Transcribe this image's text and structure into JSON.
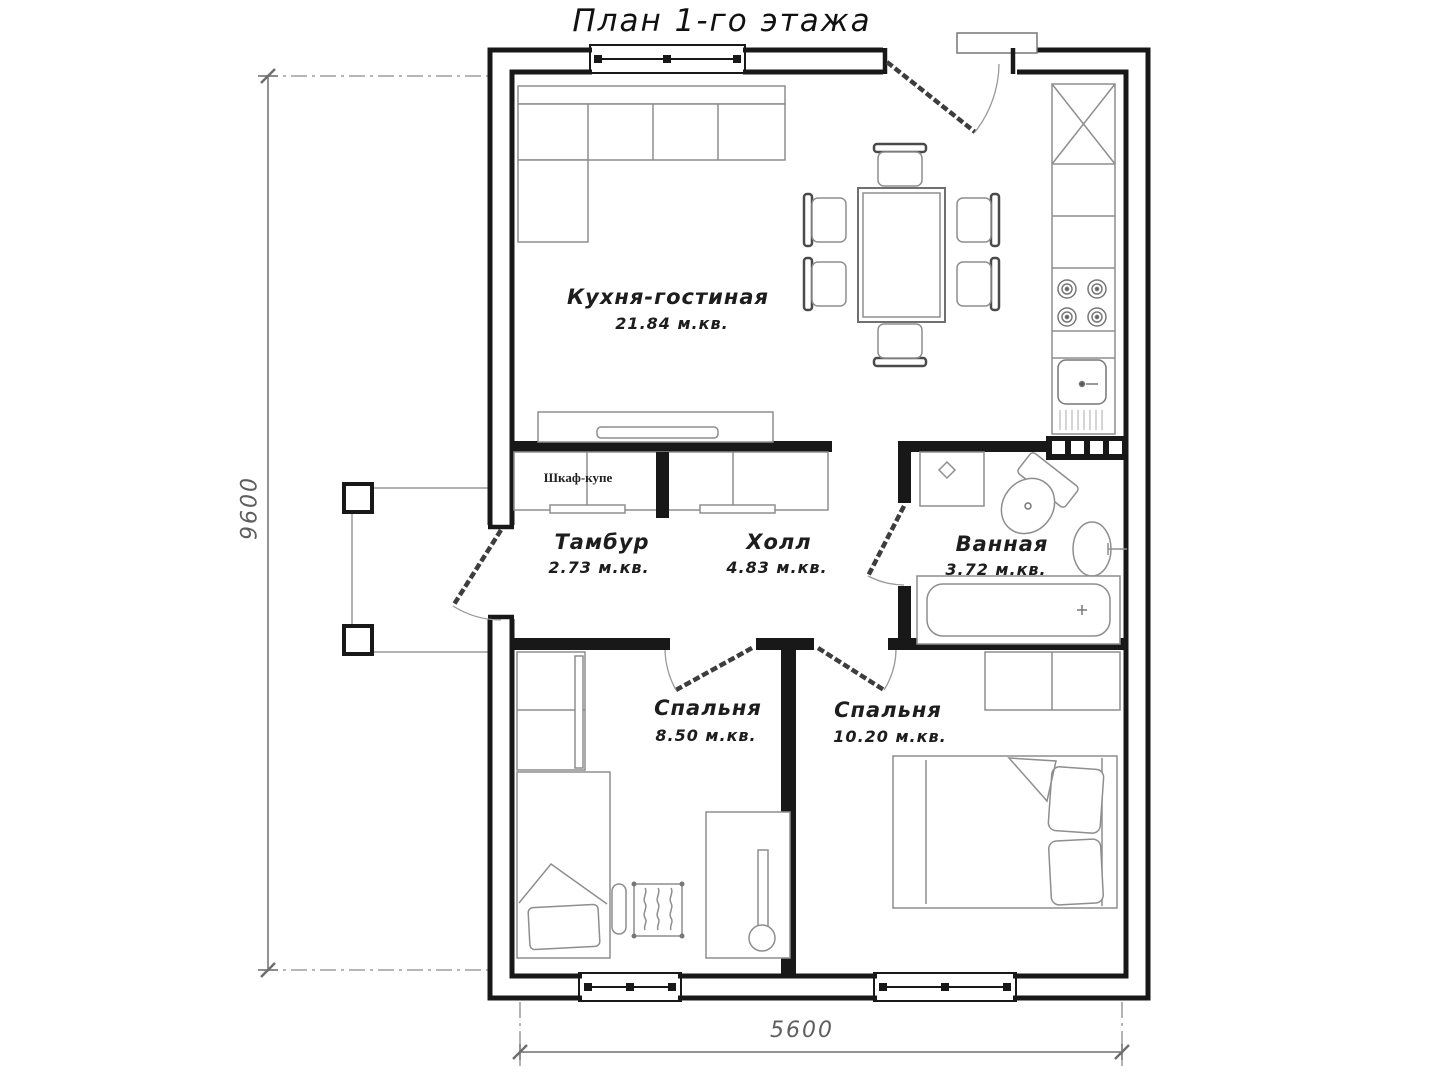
{
  "title": "План 1-го этажа",
  "rooms": {
    "kitchen": {
      "name": "Кухня-гостиная",
      "area": "21.84 м.кв."
    },
    "tambur": {
      "name": "Тамбур",
      "area": "2.73 м.кв."
    },
    "hall": {
      "name": "Холл",
      "area": "4.83 м.кв."
    },
    "bath": {
      "name": "Ванная",
      "area": "3.72 м.кв."
    },
    "bedroom1": {
      "name": "Спальня",
      "area": "8.50 м.кв."
    },
    "bedroom2": {
      "name": "Спальня",
      "area": "10.20 м.кв."
    }
  },
  "furniture": {
    "hall_wardrobe": "Шкаф-купе"
  },
  "dimensions": {
    "vertical": "9600",
    "horizontal": "5600"
  },
  "colors": {
    "wall": "#181818",
    "furniture_line": "#8e8e8e",
    "dimension_line": "#6e6e6e",
    "label_text": "#1d1d1d",
    "background": "#ffffff"
  }
}
